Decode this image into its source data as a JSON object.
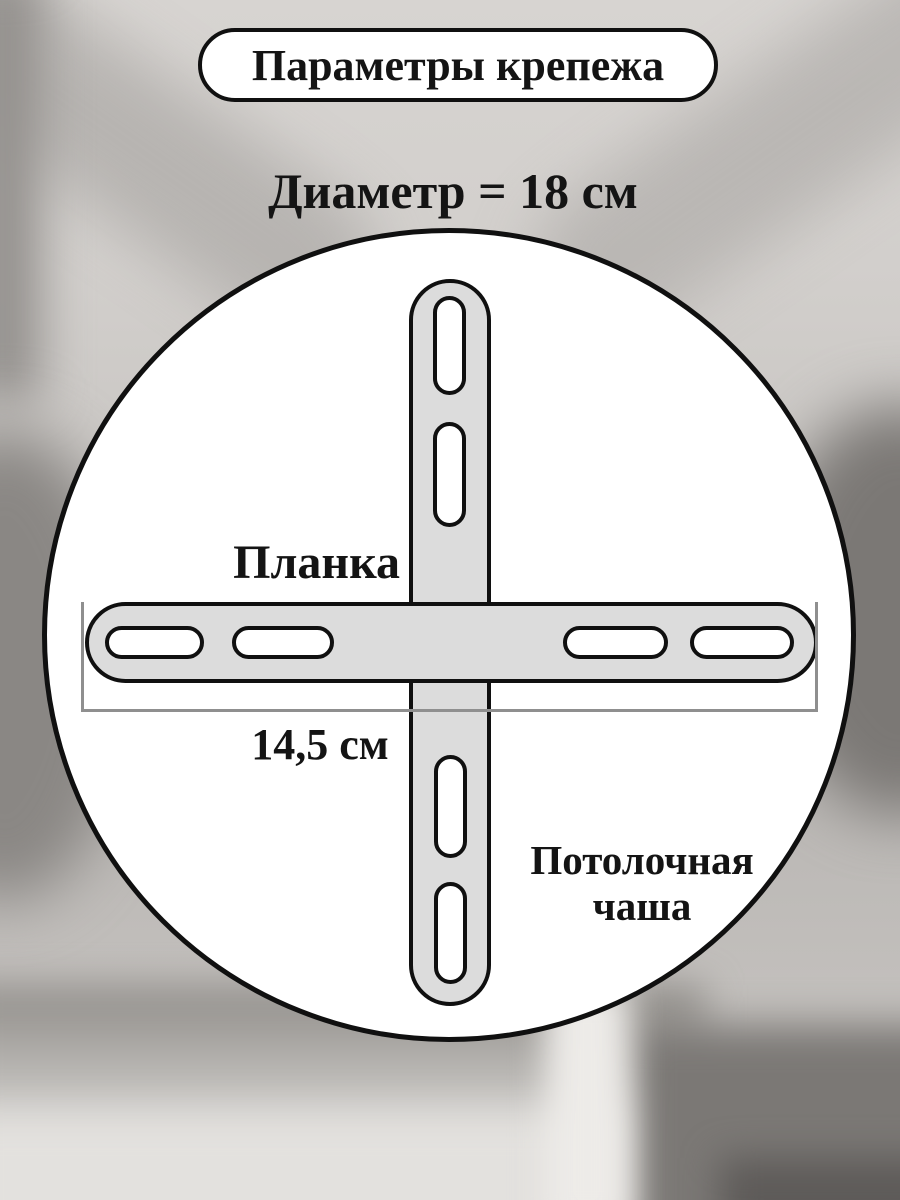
{
  "header": {
    "pill_title": "Параметры крепежа",
    "diameter_label": "Диаметр = 18 см"
  },
  "diagram": {
    "plank_label": "Планка",
    "plank_length_label": "14,5 см",
    "cup_label_line1": "Потолочная",
    "cup_label_line2": "чаша",
    "diameter_cm": 18,
    "plank_length_cm": 14.5
  },
  "colors": {
    "outline": "#101010",
    "plank_fill": "#dcdcdc",
    "circle_fill": "#ffffff",
    "dim_line": "#8f8f8f"
  }
}
